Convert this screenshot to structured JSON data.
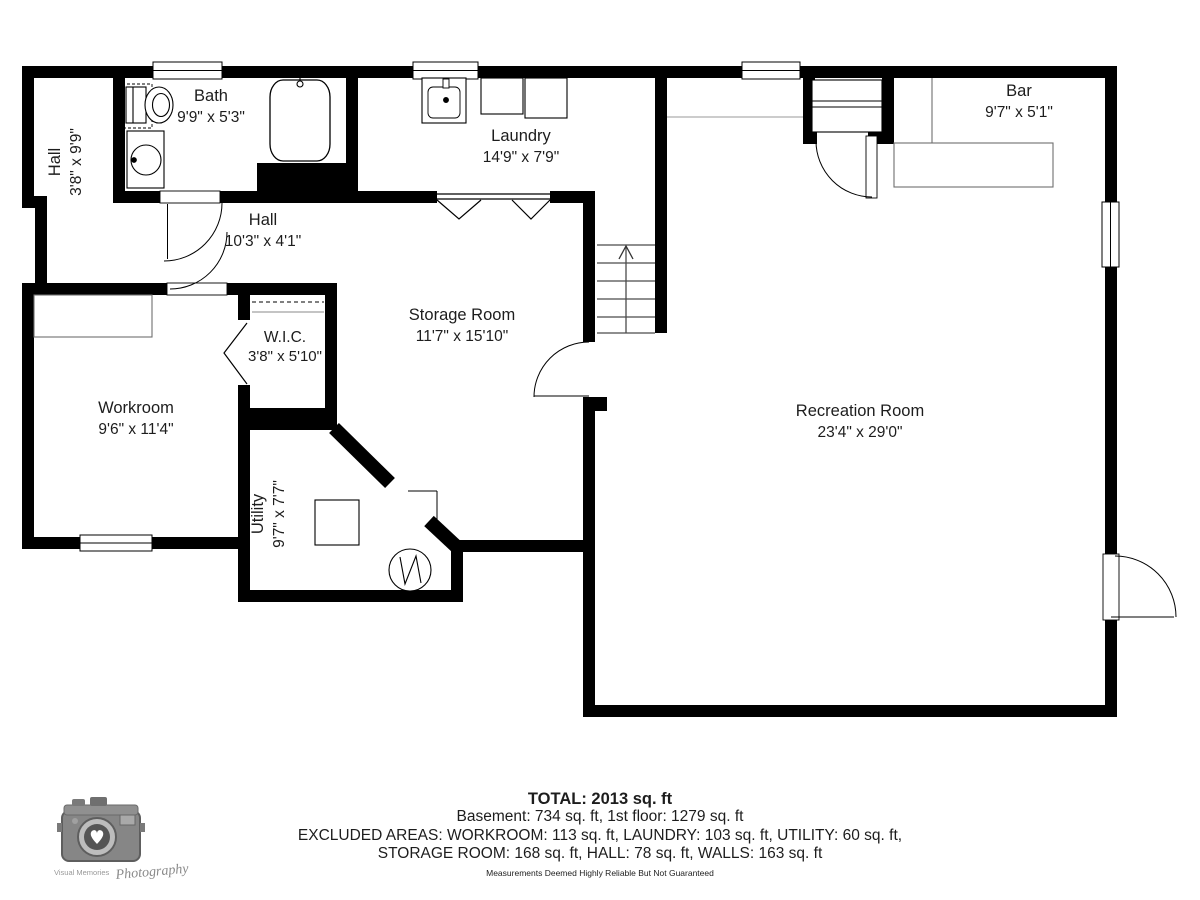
{
  "plan": {
    "rooms": {
      "hall_upper": {
        "name": "Hall",
        "dims": "3'8\" x 9'9\""
      },
      "bath": {
        "name": "Bath",
        "dims": "9'9\" x 5'3\""
      },
      "laundry": {
        "name": "Laundry",
        "dims": "14'9\" x 7'9\""
      },
      "bar": {
        "name": "Bar",
        "dims": "9'7\" x 5'1\""
      },
      "hall_lower": {
        "name": "Hall",
        "dims": "10'3\" x 4'1\""
      },
      "storage": {
        "name": "Storage Room",
        "dims": "11'7\" x 15'10\""
      },
      "wic": {
        "name": "W.I.C.",
        "dims": "3'8\" x 5'10\""
      },
      "workroom": {
        "name": "Workroom",
        "dims": "9'6\" x 11'4\""
      },
      "utility": {
        "name": "Utility",
        "dims": "9'7\" x 7'7\""
      },
      "recreation": {
        "name": "Recreation Room",
        "dims": "23'4\" x 29'0\""
      }
    }
  },
  "footer": {
    "total": "TOTAL: 2013 sq. ft",
    "line1": "Basement: 734 sq. ft, 1st floor: 1279 sq. ft",
    "line2": "EXCLUDED AREAS: WORKROOM: 113 sq. ft, LAUNDRY: 103 sq. ft, UTILITY: 60 sq. ft,",
    "line3": "STORAGE ROOM: 168 sq. ft, HALL: 78 sq. ft, WALLS: 163 sq. ft",
    "disclaimer": "Measurements Deemed Highly Reliable But Not Guaranteed"
  },
  "logo": {
    "brand": "Visual Memories",
    "script": "Photography"
  },
  "colors": {
    "wall": "#000000",
    "counter": "#6e6e6e",
    "stair_line": "#4a4a4a",
    "label": "#1d1d1d",
    "logo_gray": "#8a8a8a"
  }
}
